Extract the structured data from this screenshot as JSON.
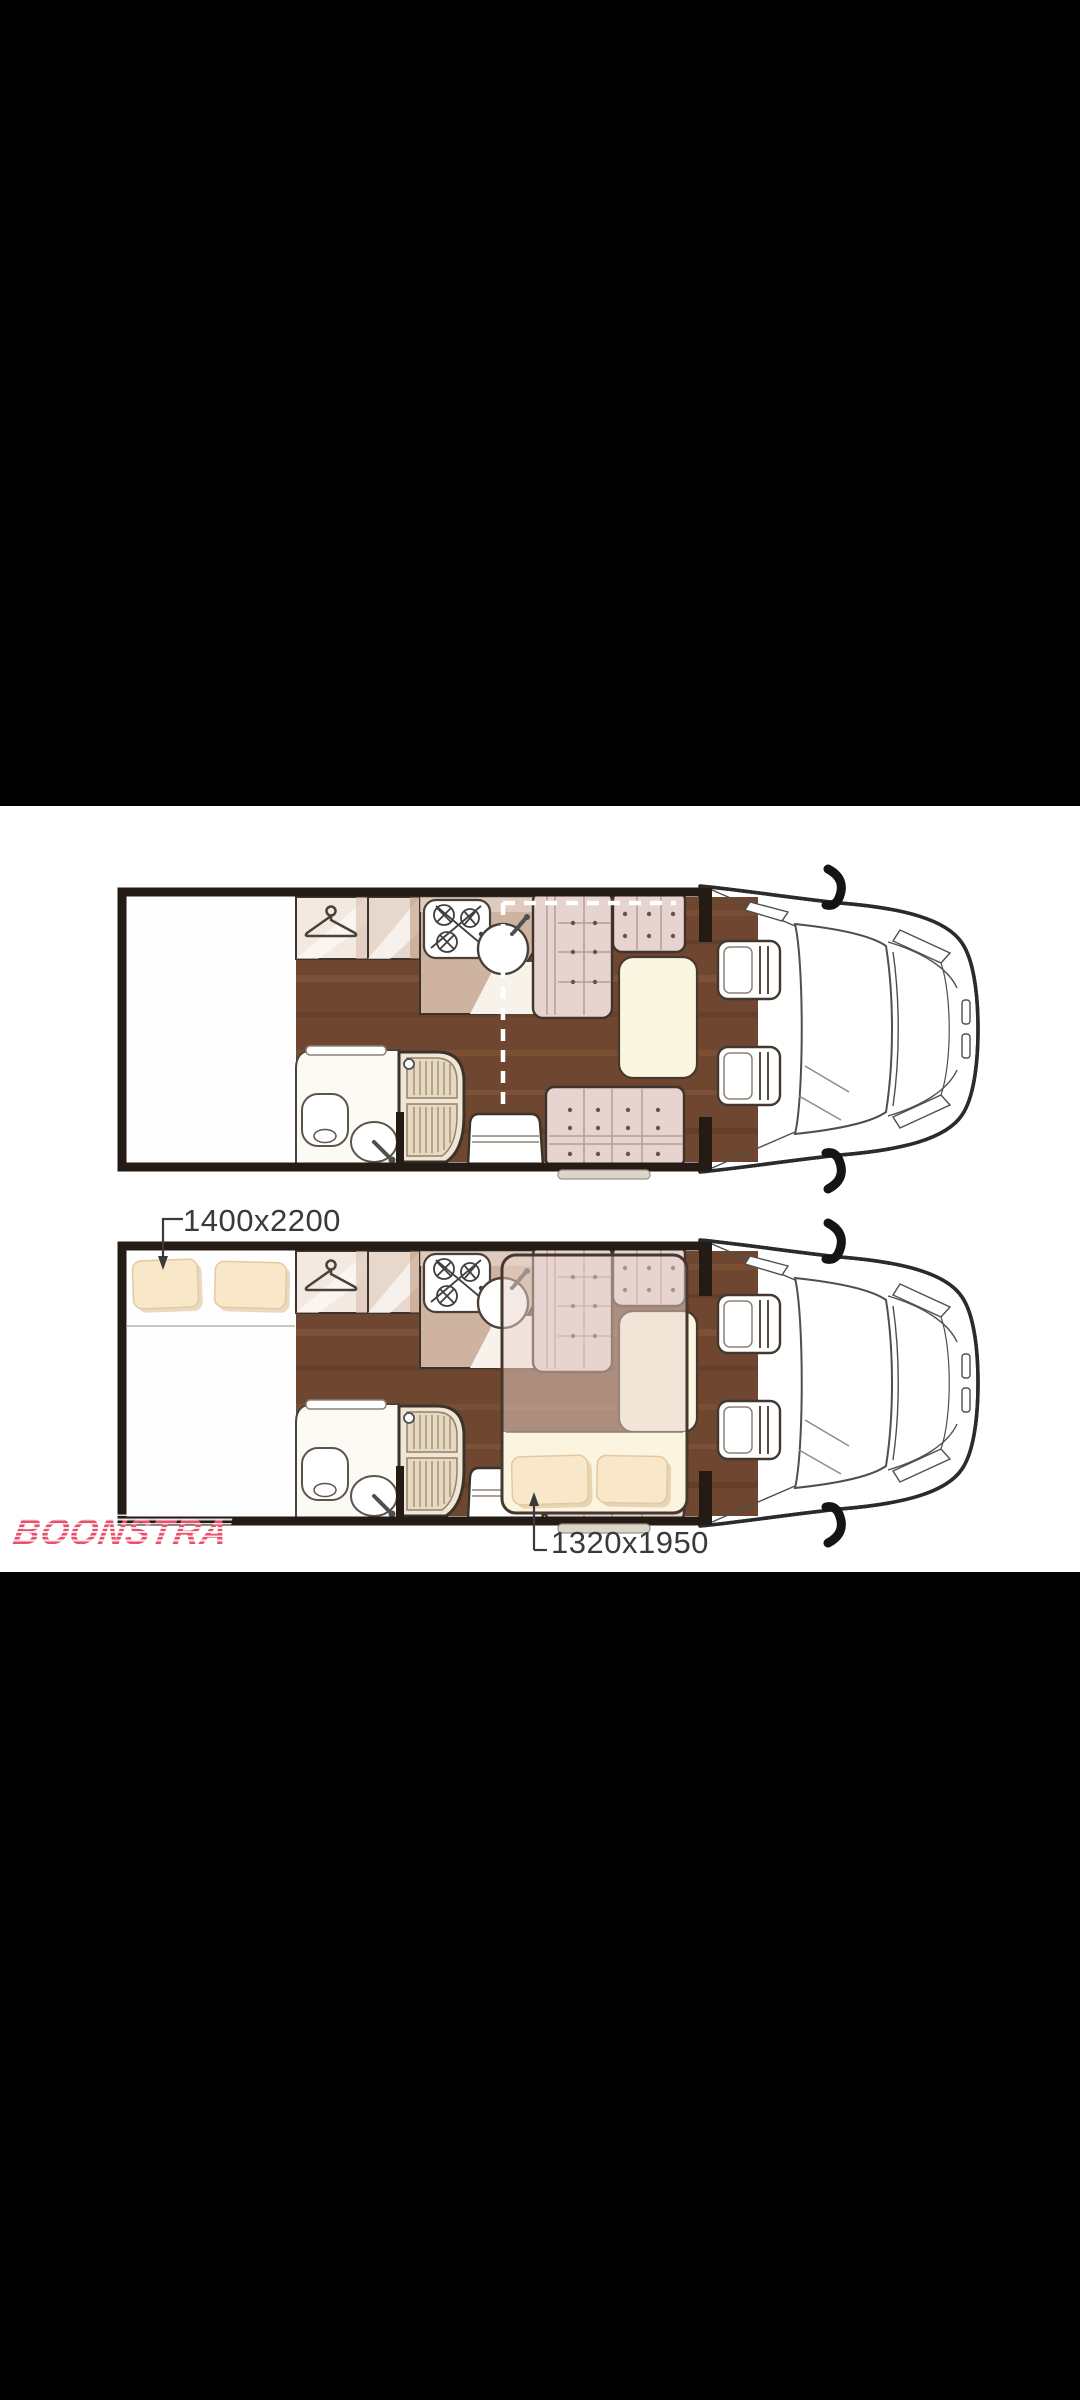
{
  "viewer": {
    "background": "#000000",
    "panel_background": "#ffffff"
  },
  "watermark": {
    "text": "BOONSTRA",
    "color": "#e8506b"
  },
  "floorplans": {
    "bottom_plan": {
      "rear_bed_label": "1400x2200",
      "drop_down_bed_label": "1320x1950"
    }
  },
  "colors": {
    "floor_wood": "#6f4630",
    "upholstery_pink": "#e7d4d0",
    "pillow_beige": "#f8e7c9",
    "table_cream": "#fbf6e2",
    "wall_outline": "#241b14",
    "label_text": "#3a3a3a"
  }
}
